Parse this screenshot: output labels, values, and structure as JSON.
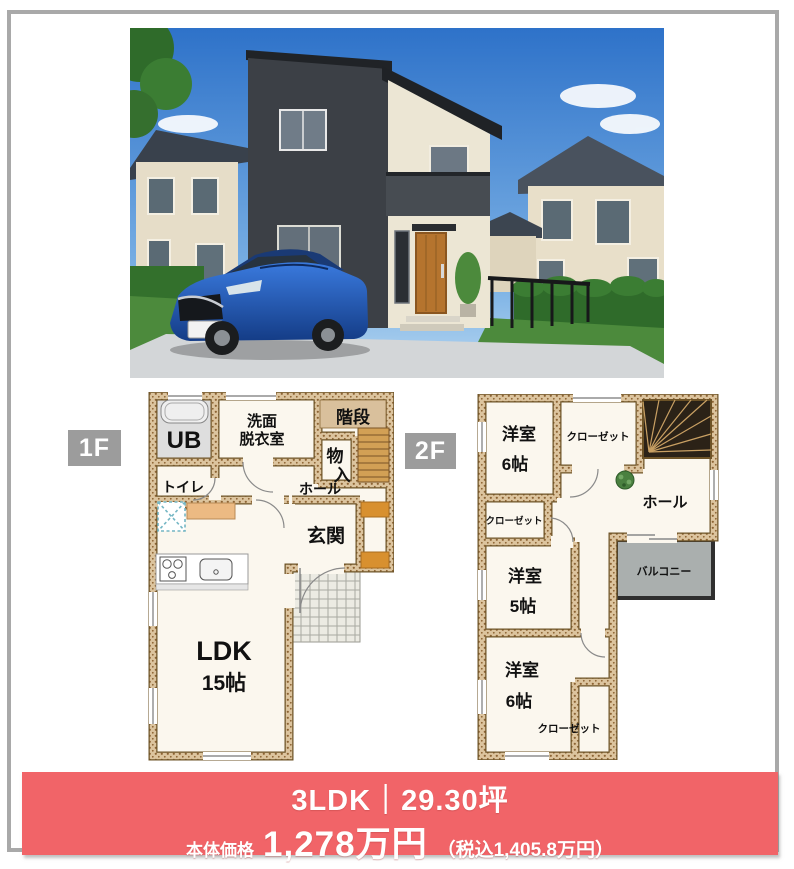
{
  "colors": {
    "banner_bg": "#f16468",
    "floor_badge_bg": "#9c9c9c",
    "page_border": "#a9a9a9",
    "wall_tan": "#dcc49e",
    "balcony_fill": "#aaafae",
    "stair_dark": "#2b2217"
  },
  "photo": {
    "description": "exterior-photo-house-with-blue-car"
  },
  "floor1": {
    "label": "1F",
    "rooms": {
      "ub": "UB",
      "senmen_line1": "洗面",
      "senmen_line2": "脱衣室",
      "kaidan": "階段",
      "monoire_line1": "物",
      "monoire_line2": "入",
      "toilet": "トイレ",
      "hall": "ホール",
      "genkan": "玄関",
      "ldk": "LDK",
      "ldk_size": "15帖"
    }
  },
  "floor2": {
    "label": "2F",
    "rooms": {
      "west_top": "洋室",
      "west_top_size": "6帖",
      "closet_top": "クローゼット",
      "hall": "ホール",
      "closet_mid": "クローゼット",
      "west_mid": "洋室",
      "west_mid_size": "5帖",
      "balcony": "バルコニー",
      "west_bottom": "洋室",
      "west_bottom_size": "6帖",
      "closet_bottom": "クローゼット"
    }
  },
  "banner": {
    "headline": "3LDK｜29.30坪",
    "price_label": "本体価格",
    "price_value": "1,278万円",
    "price_tax": "（税込1,405.8万円）"
  }
}
